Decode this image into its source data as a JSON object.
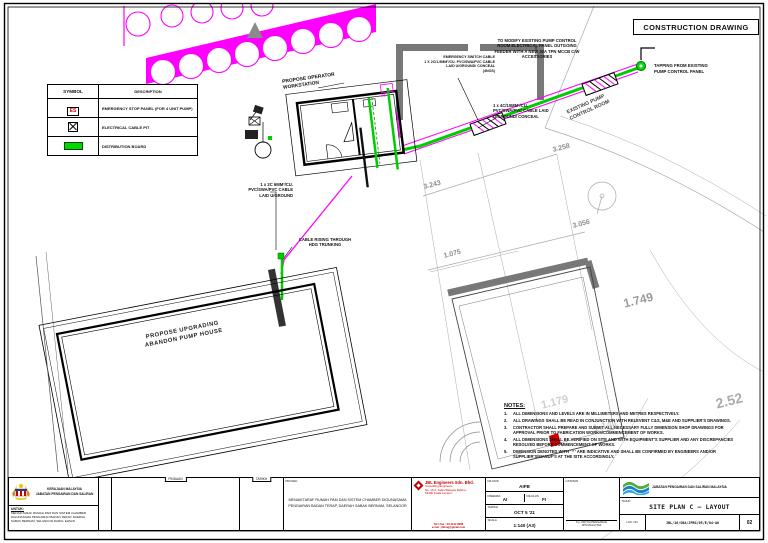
{
  "stamp": {
    "label": "CONSTRUCTION DRAWING"
  },
  "legend": {
    "headers": [
      "SYMBOL",
      "DESCRIPTION"
    ],
    "es_symbol": "ES",
    "rows": [
      {
        "symbol": "emergency-stop",
        "description": "EMERGENCY STOP PANEL (FOR 4 UNIT PUMP)"
      },
      {
        "symbol": "cable-pit",
        "description": "ELECTRICAL CABLE PIT"
      },
      {
        "symbol": "distribution-board",
        "description": "DISTRIBUTION BOARD"
      }
    ]
  },
  "annotations": {
    "workstation": "PROPOSE OPERATOR\nWORKSTATION",
    "es_tag": "ES",
    "emergency_switch_cable": "EMERGENCY SWITCH CABLE\n1 X 2C/1.5MM²/CU. PVC/SWA/PVC CABLE\nLAID U/GROUND/ CONCEAL\n(4NOS)",
    "modify_panel": "TO MODIFY EXISTING PUMP CONTROL\nROOM ELECTRICAL PANEL OUTGOING\nFEEDER WITH A NEW 30A TPN MCCB C/W\nACCESSORIES",
    "tapping": "TAPPING FROM EXISTING\nPUMP CONTROL PANEL",
    "cable_4c": "1 x 4C/10MM²/CU.\nPVC/SWA/PVC CABLE LAID\nU/GROUND/ CONCEAL",
    "existing_pump_room": "EXISTING PUMP\nCONTROL ROOM",
    "cable_2c": "1 x 2C 6MM²/CU.\nPVC/SWA/PVC CABLE\nLAID U/GROUND",
    "cable_rising": "CABLE RISING THROUGH\nHDG TRUNKING",
    "pump_house": "PROPOSE UPGRADING\nABANDON PUMP HOUSE"
  },
  "dims": {
    "d1": "3.258",
    "d2": "3.243",
    "d3": "3.056",
    "d4": "1.075",
    "d5": "1.749",
    "d6": "2.52",
    "d7": "1.179",
    "d8": "1.141"
  },
  "notes": {
    "title": "NOTES:",
    "items": [
      {
        "n": "1.",
        "text": "ALL DIMENSIONS AND LEVELS ARE IN MILLIMETERS AND METRES RESPECTIVELY."
      },
      {
        "n": "2.",
        "text": "ALL DRAWINGS SHALL BE READ IN CONJUNCTION WITH RELEVENT C&S, M&E AND SUPPLIER'S DRAWINGS."
      },
      {
        "n": "3.",
        "text": "CONTRACTOR SHALL PREPARE AND SUBMIT ALL NECESSARY FULLY DIMENSION SHOP DRAWINGS FOR APPROVAL PRIOR TO FABRICATION WORKS/COMMENCEMENT OF WORKS."
      },
      {
        "n": "4.",
        "text": "ALL DIMENSIONS SHALL BE VERIFIED ON SITE AND WITH EQUIPMENT'S SUPPLIER AND ANY DISCREPANCIES RESOLVED BEFORE COMMENCEMENT OF WORKS."
      },
      {
        "n": "5.",
        "text": "DIMENSION DENOTED WITH ' * ' ARE INDICATIVE AND SHALL BE CONFIRMED BY ENGINEERS AND/OR SUPPLIER'S/MANUF'S AT THE SITE ACCORDINGLY."
      }
    ]
  },
  "titleblock": {
    "agency_line1": "KERAJAAN MALAYSIA",
    "agency_line2": "JABATAN PENGAIRAN DAN SALIRAN",
    "untuk_label": "UNTUK:",
    "untuk_text": "MENAIKTARAF RUMAH PAM DAN SISTEM CHAMBER DIGUNASAMA PENGAIRAN BADAN TERAP, DAERAH SABAK BERNAM, SELANGOR DARUL EHSAN",
    "rev_pindaan": "PINDAAN",
    "rev_tarikh": "TARIKH",
    "projek_label": "PROJEK:",
    "project_title": "MENAIKTARAF RUMAH PAM DAN SISTEM CHAMBER DIGUNASAMA\nPENGAIRAN BADAN TERAP, DAERAH SABAK BERNAM, SELANGOR",
    "consultant": {
      "name": "JBL Engineers Sdn. Bhd.",
      "tagline": "Consulting Engineers",
      "addr1": "No. 16-2, Jalan Wangsa Delima,",
      "addr2": "53300 Kuala Lumpur.",
      "foot1": "Tel / Fax : 03-4142 8088",
      "foot2": "e-mel : jbleng@gmail.com"
    },
    "fields": {
      "dilukis_label": "DILUKIS",
      "dilukis": "AIFB",
      "disemak_label": "DISEMAK",
      "disemak": "AI",
      "dilulus_label": "DILULUS",
      "dilulus": "FI",
      "tarikh_label": "TARIKH",
      "tarikh": "OCT 5 '21",
      "skala_label": "SKALA",
      "skala": "1:140 (A3)"
    },
    "catatan_label": "CATATAN",
    "sig1": "b.p. KETUA PENGARAH",
    "sig2": "JPS MALAYSIA",
    "jps_name": "JABATAN PENGAIRAN DAN SALIRAN MALAYSIA",
    "tajuk_label": "TAJUK:",
    "drawing_title": "SITE PLAN C — LAYOUT",
    "luk_label": "LUK. NO.",
    "drawing_no": "JBL/16/SBA/JPRG/05/E/04-A0",
    "sht_label": "SHT",
    "sheet_no": "02"
  }
}
